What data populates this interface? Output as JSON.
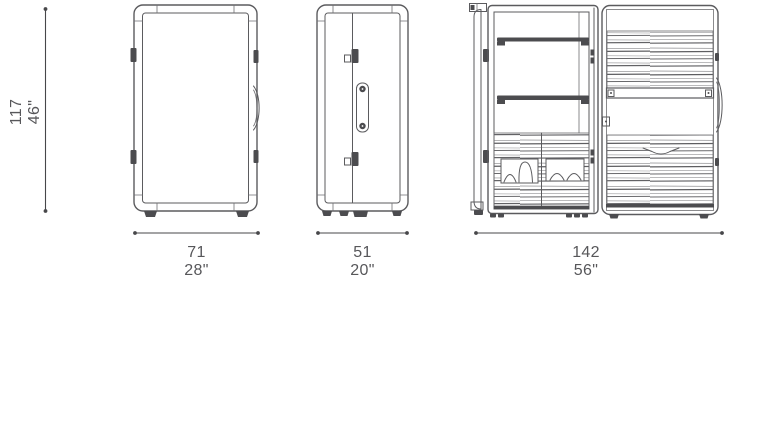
{
  "colors": {
    "background": "#ffffff",
    "line": "#5b5b5e",
    "dark_fill": "#4c4c4f",
    "stripe": "#77777a",
    "dimension_line": "#47474a",
    "text": "#57575a"
  },
  "icons": [
    "hinge-icon",
    "latch-icon",
    "handle-icon",
    "shelf",
    "shoe-drawer",
    "foot",
    "tambour-door"
  ],
  "dimensions": {
    "height": {
      "cm": "117",
      "in": "46\""
    },
    "width": {
      "cm": "71",
      "in": "28\""
    },
    "depth": {
      "cm": "51",
      "in": "20\""
    },
    "open_width": {
      "cm": "142",
      "in": "56\""
    }
  }
}
